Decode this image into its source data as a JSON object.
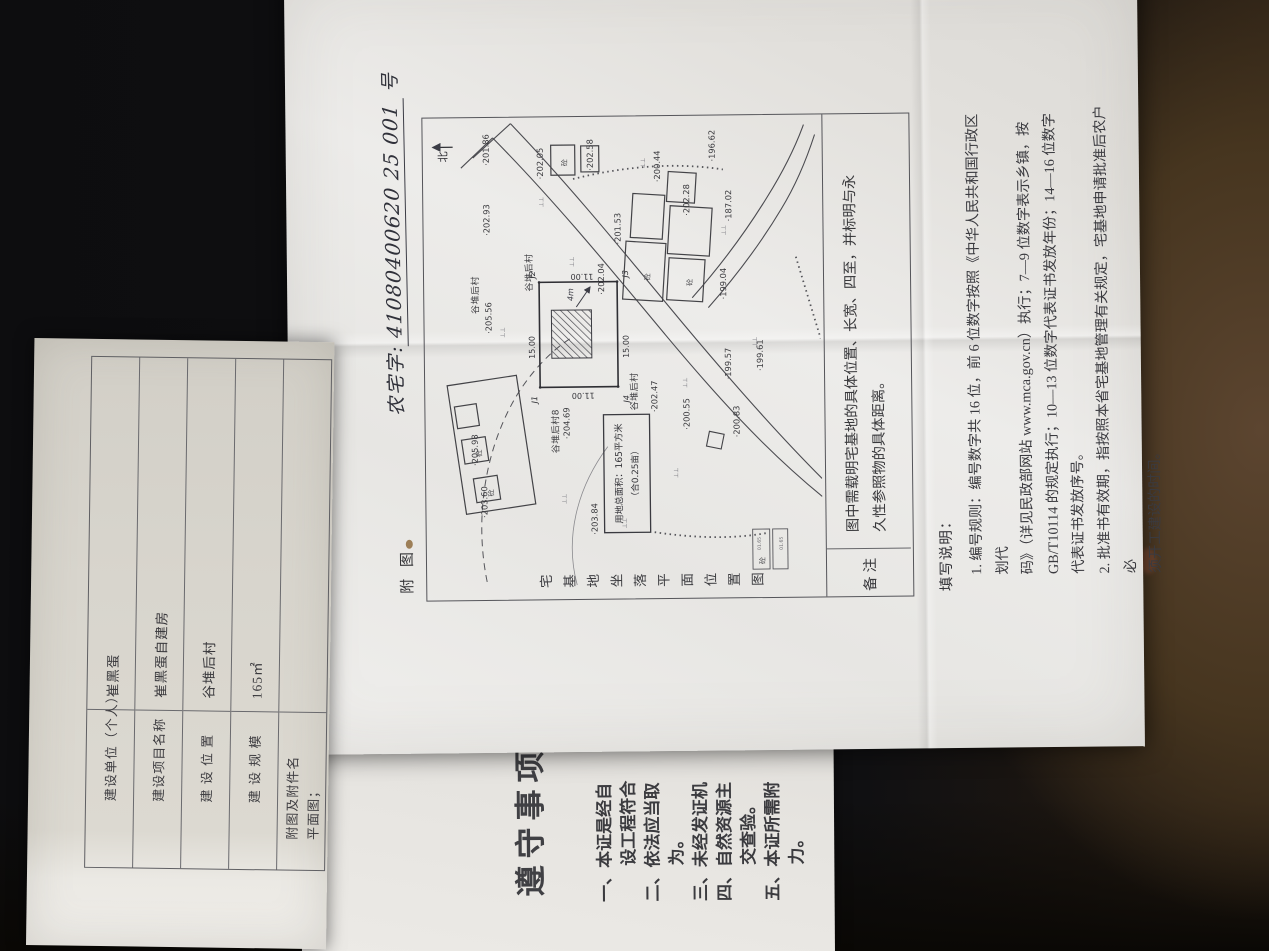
{
  "doc": {
    "number_prefix": "农宅字:",
    "number_value": "41080400620 25 001",
    "number_suffix": "号",
    "map_label": "附 图",
    "map_title": "宅基地坐落平面位置图",
    "remark": {
      "label": "备注",
      "lines": [
        "图中需载明宅基地的具体位置、长宽、四至，并标明与永",
        "久性参照物的具体距离。"
      ]
    },
    "notes": {
      "title": "填写说明：",
      "lines": [
        "1. 编号规则：编号数字共 16 位，前 6 位数字按照《中华人民共和国行政区划代",
        "码》（详见民政部网站 www.mca.gov.cn）执行；7—9 位数字表示乡镇，按",
        "GB/T10114 的规定执行；10—13 位数字代表证书发放年份；14—16 位数字",
        "代表证书发放序号。",
        "2. 批准书有效期，指按照本省宅基地管理有关规定，宅基地申请批准后农户必",
        "须开工建设的时间。"
      ]
    }
  },
  "map": {
    "compass": "北",
    "grass": "⊥⊥",
    "building": "砼",
    "annotation": "4m",
    "area_box": [
      "用地总面积：165平方米",
      "（合0.25亩）"
    ],
    "plot": {
      "j1": "J1",
      "j2": "J2",
      "j3": "J3",
      "j4": "J4",
      "len": "15.00",
      "wid": "11.00"
    },
    "villages": [
      "谷堆后村",
      "谷堆后村",
      "谷堆后村8",
      "谷堆后村"
    ],
    "legend": [
      "砼",
      "01.65",
      "01.65"
    ],
    "elevations": [
      "·201.86",
      "·202.05",
      "·202.58",
      "·200.44",
      "·196.62",
      "·202.28",
      "·187.02",
      "·202.93",
      "·201.53",
      "·202.04",
      "·205.56",
      "·204.69",
      "·202.47",
      "·200.55",
      "·200.83",
      "·199.57",
      "·199.61",
      "·199.04",
      "·205.98",
      "·203.60",
      "·203.84"
    ]
  },
  "form": {
    "rows": [
      {
        "label": "建设单位（个人）",
        "value": "崔黑蛋"
      },
      {
        "label": "建设项目名称",
        "value": "崔黑蛋自建房"
      },
      {
        "label": "建 设 位 置",
        "value": "谷堆后村"
      },
      {
        "label": "建 设 规 模",
        "value": "165㎡"
      },
      {
        "label": "附图及附件名",
        "value": "平面图；"
      }
    ]
  },
  "rules": {
    "title": "遵守事项",
    "lines": [
      "一、本证是经自",
      "设工程符合",
      "二、依法应当取",
      "为。",
      "三、未经发证机",
      "四、自然资源主",
      "交查验。",
      "五、本证所需附",
      "力。"
    ]
  }
}
